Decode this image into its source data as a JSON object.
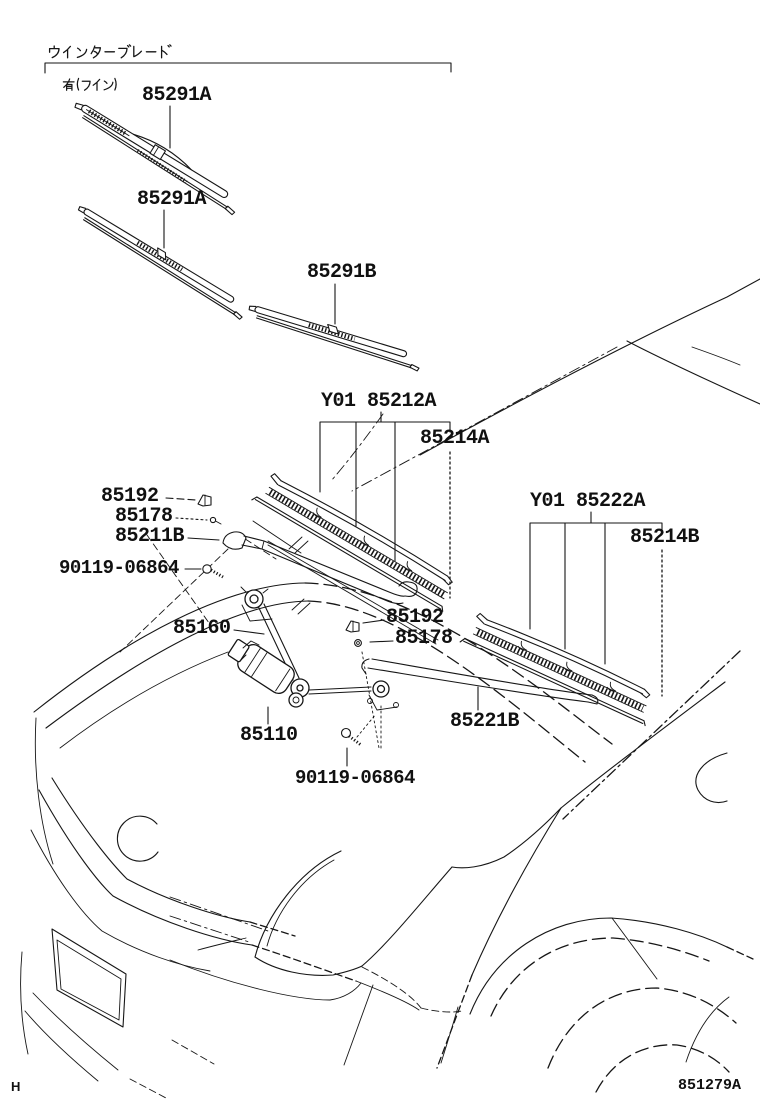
{
  "diagram": {
    "title_jp": "ウインターブレード",
    "subtitle_jp": "有(フイン)",
    "figure_code": "851279A",
    "page_code": "H"
  },
  "labels": {
    "blade_fin": "85291A",
    "blade_std": "85291A",
    "blade_b": "85291B",
    "group_212": "Y01 85212A",
    "insert_a": "85214A",
    "group_222": "Y01 85222A",
    "insert_b": "85214B",
    "clip_left": "85192",
    "screw_left": "85178",
    "arm_driver": "85211B",
    "bolt_left": "90119-06864",
    "link": "85160",
    "clip_right": "85192",
    "screw_right": "85178",
    "arm_passenger": "85221B",
    "motor": "85110",
    "bolt_right": "90119-06864"
  },
  "colors": {
    "line": "#161616",
    "background": "#ffffff"
  }
}
